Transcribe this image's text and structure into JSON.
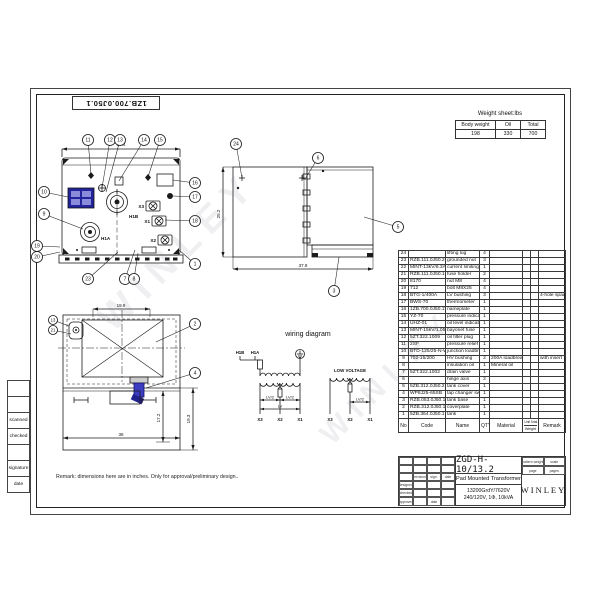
{
  "sheet": {
    "doc_number_top": "1ZB.700.0J50.1",
    "remark": "Remark: dimensions here are in inches. Only for approval/preliminary design..",
    "watermark": "WINLEY"
  },
  "left_margin_boxes": [
    "",
    "",
    "scanned",
    "checked",
    "",
    "signature",
    "date"
  ],
  "weight_sheet": {
    "title": "Weight sheet:lbs",
    "headers": [
      "Body weight",
      "Oil",
      "Total"
    ],
    "values": [
      "198",
      "330",
      "700"
    ]
  },
  "parts_list": {
    "headers": {
      "no": "No",
      "code": "Code",
      "name": "Name",
      "qty": "QTY",
      "material": "Material",
      "weight_unit": "Unit",
      "weight_total": "Total",
      "weight": "Weight",
      "remark": "Remark"
    },
    "rows": [
      {
        "no": "24",
        "code": "",
        "name": "lifting lug",
        "qty": "4",
        "material": "",
        "remark": ""
      },
      {
        "no": "23",
        "code": "RZB.111.0J50.2",
        "name": "grounded nut",
        "qty": "3",
        "material": "",
        "remark": ""
      },
      {
        "no": "22",
        "code": "MINT-13kV/6.3A",
        "name": "current limiting fuse",
        "qty": "1",
        "material": "",
        "remark": ""
      },
      {
        "no": "21",
        "code": "RZB.111.0J50.1",
        "name": "fuse holder",
        "qty": "2",
        "material": "",
        "remark": ""
      },
      {
        "no": "20",
        "code": "8170",
        "name": "nut M8",
        "qty": "4",
        "material": "",
        "remark": ""
      },
      {
        "no": "19",
        "code": "712",
        "name": "bolt M8X25",
        "qty": "4",
        "material": "",
        "remark": ""
      },
      {
        "no": "18",
        "code": "BTG-1/400A",
        "name": "LV bushing",
        "qty": "3",
        "material": "",
        "remark": "4-hole spade"
      },
      {
        "no": "17",
        "code": "BWS-70",
        "name": "thermometer",
        "qty": "1",
        "material": "",
        "remark": ""
      },
      {
        "no": "16",
        "code": "1ZB.700.0J50.1WP",
        "name": "nameplate",
        "qty": "1",
        "material": "",
        "remark": ""
      },
      {
        "no": "15",
        "code": "YZ-70",
        "name": "pressure indicator",
        "qty": "1",
        "material": "",
        "remark": ""
      },
      {
        "no": "14",
        "code": "UHZ-01",
        "name": "oil level indicator",
        "qty": "1",
        "material": "",
        "remark": ""
      },
      {
        "no": "13",
        "code": "MINT-15kV/1.05A",
        "name": "bayonet fuse",
        "qty": "1",
        "material": "",
        "remark": ""
      },
      {
        "no": "12",
        "code": "5ZT.322.1009",
        "name": "oil filter plug",
        "qty": "1",
        "material": "",
        "remark": ""
      },
      {
        "no": "11",
        "code": "2SF",
        "name": "pressure relief valve",
        "qty": "1",
        "material": "",
        "remark": ""
      },
      {
        "no": "10",
        "code": "BTD-125/25-N-W",
        "name": "junction loadbreak",
        "qty": "1",
        "material": "",
        "remark": ""
      },
      {
        "no": "9",
        "code": "702-15/200",
        "name": "HV bushing",
        "qty": "2",
        "material": "200A loadbreak",
        "remark": "with insert"
      },
      {
        "no": "8",
        "code": "",
        "name": "insulation oil",
        "qty": "1",
        "material": "Mineral oil",
        "remark": ""
      },
      {
        "no": "7",
        "code": "5ZT.322.1002",
        "name": "drain valve",
        "qty": "1",
        "material": "",
        "remark": ""
      },
      {
        "no": "6",
        "code": "",
        "name": "hinge axis",
        "qty": "2",
        "material": "",
        "remark": ""
      },
      {
        "no": "5",
        "code": "5ZB.312.0J50.2",
        "name": "tank cover",
        "qty": "1",
        "material": "",
        "remark": ""
      },
      {
        "no": "4",
        "code": "WP8J25-65SB",
        "name": "tap changer switch",
        "qty": "1",
        "material": "",
        "remark": ""
      },
      {
        "no": "3",
        "code": "RZB.053.0J50.1",
        "name": "tank base",
        "qty": "1",
        "material": "",
        "remark": ""
      },
      {
        "no": "2",
        "code": "RZB.312.0J50.1",
        "name": "coverplate",
        "qty": "1",
        "material": "",
        "remark": ""
      },
      {
        "no": "1",
        "code": "5ZB.364.0J50.1",
        "name": "tank",
        "qty": "1",
        "material": "",
        "remark": ""
      }
    ]
  },
  "title_block": {
    "drawing_number": "ZGD-H-10/13.2",
    "product_name": "Pad Mounted Transformer",
    "spec_line1": "13200GrdY/7620V",
    "spec_line2": "240/120V, 1Φ, 10kVA",
    "company": "WINLEY",
    "left_grid": [
      [
        "",
        "",
        "",
        ""
      ],
      [
        "",
        "",
        "",
        ""
      ],
      [
        "",
        "revision",
        "sign.",
        "date"
      ],
      [
        "designed",
        "",
        "",
        ""
      ],
      [
        "checked",
        "",
        "",
        ""
      ],
      [
        "approved",
        "",
        "date",
        ""
      ]
    ],
    "right_rows": [
      [
        "pattern weight",
        "scale"
      ],
      [
        "page",
        "pages"
      ]
    ]
  },
  "views": {
    "front": {
      "dim_top": "37.4",
      "label_h1b": "H1B",
      "label_h1a": "H1A",
      "label_x1": "X1",
      "label_x2": "X2",
      "label_x3": "X3",
      "balloons": [
        {
          "n": "11",
          "x": 56,
          "y": 12,
          "tx": 59,
          "ty": 47
        },
        {
          "n": "12",
          "x": 78,
          "y": 12,
          "tx": 70,
          "ty": 60
        },
        {
          "n": "13",
          "x": 88,
          "y": 12,
          "tx": 74,
          "ty": 64
        },
        {
          "n": "14",
          "x": 112,
          "y": 12,
          "tx": 87,
          "ty": 53
        },
        {
          "n": "15",
          "x": 128,
          "y": 12,
          "tx": 116,
          "ty": 49
        },
        {
          "n": "16",
          "x": 163,
          "y": 55,
          "tx": 141,
          "ty": 52
        },
        {
          "n": "17",
          "x": 163,
          "y": 69,
          "tx": 141,
          "ty": 68
        },
        {
          "n": "18",
          "x": 163,
          "y": 93,
          "tx": 133,
          "ty": 92
        },
        {
          "n": "10",
          "x": 12,
          "y": 64,
          "tx": 36,
          "ty": 69
        },
        {
          "n": "9",
          "x": 12,
          "y": 86,
          "tx": 51,
          "ty": 101
        },
        {
          "n": "19",
          "x": 5,
          "y": 118,
          "tx": 28,
          "ty": 119
        },
        {
          "n": "20",
          "x": 5,
          "y": 129,
          "tx": 28,
          "ty": 124
        },
        {
          "n": "1",
          "x": 163,
          "y": 136,
          "tx": 147,
          "ty": 122
        },
        {
          "n": "23",
          "x": 56,
          "y": 151,
          "tx": 86,
          "ty": 124
        },
        {
          "n": "7",
          "x": 93,
          "y": 151,
          "tx": 103,
          "ty": 122
        },
        {
          "n": "8",
          "x": 102,
          "y": 151,
          "tx": 106,
          "ty": 125
        }
      ]
    },
    "side": {
      "dim_height": "25.2",
      "dim_width": "37.9",
      "balloons": [
        {
          "n": "24",
          "x": 20,
          "y": 6,
          "tx": 26,
          "ty": 40
        },
        {
          "n": "6",
          "x": 102,
          "y": 20,
          "tx": 89,
          "ty": 41
        },
        {
          "n": "5",
          "x": 182,
          "y": 89,
          "tx": 148,
          "ty": 79
        },
        {
          "n": "3",
          "x": 118,
          "y": 153,
          "tx": 123,
          "ty": 119
        }
      ]
    },
    "plan": {
      "dim_top": "19.9",
      "dim_right1": "17.2",
      "dim_right2": "19.3",
      "dim_bottom": "36",
      "balloons": [
        {
          "n": "13",
          "x": 7,
          "y": 28,
          "tx": 23,
          "ty": 34,
          "r": 4.5
        },
        {
          "n": "21",
          "x": 7,
          "y": 38,
          "tx": 25,
          "ty": 42,
          "r": 4.5
        },
        {
          "n": "2",
          "x": 149,
          "y": 32,
          "tx": 110,
          "ty": 50
        },
        {
          "n": "4",
          "x": 149,
          "y": 81,
          "tx": 100,
          "ty": 96
        }
      ]
    }
  },
  "wiring": {
    "title": "wiring diagram",
    "h1b": "H1B",
    "h1a": "H1A",
    "low_voltage": "LOW VOLTAGE",
    "lv_half": "LV/2",
    "lv": "LV",
    "x1": "X1",
    "x2": "X2",
    "x3": "X3"
  },
  "colors": {
    "line": "#1b1b1b",
    "nameplate_blue": "#23239b",
    "nameplate_light": "#8b8bdc",
    "tap_changer_blue": "#3d3dc4",
    "tap_changer_dark": "#22228f"
  }
}
